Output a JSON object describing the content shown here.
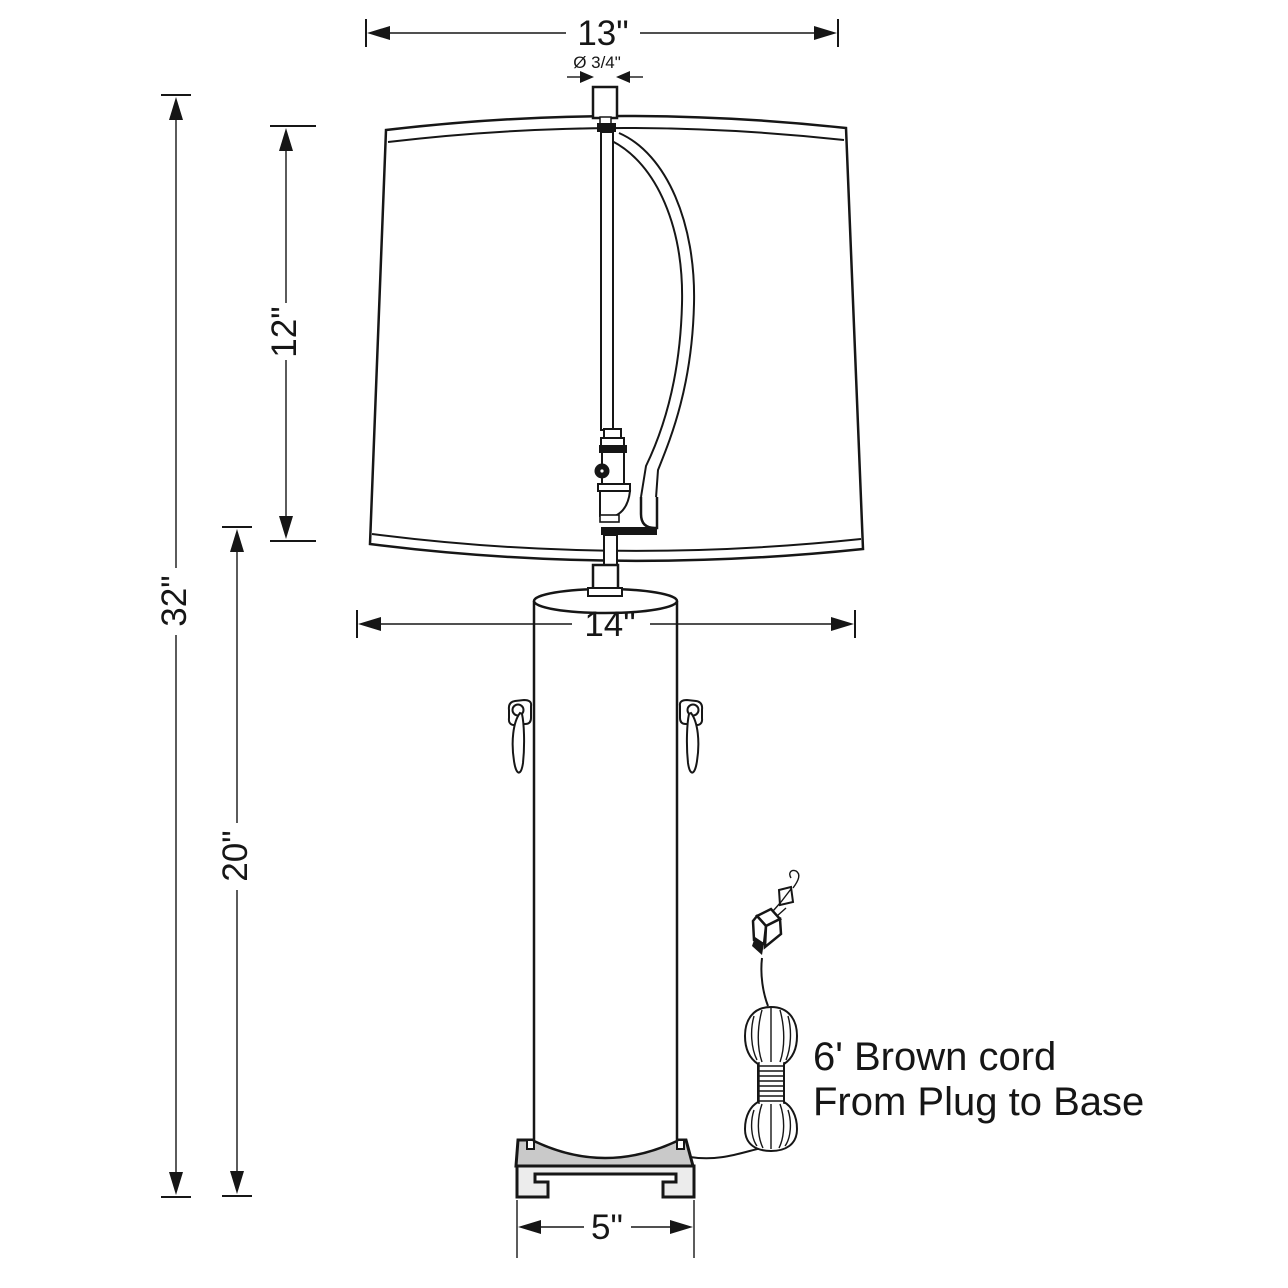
{
  "drawing": {
    "title": "table-lamp-dimension-diagram",
    "dimensions": {
      "shade_top_width": "13\"",
      "finial_diameter": "Ø 3/4\"",
      "shade_height": "12\"",
      "total_height": "32\"",
      "body_top_width": "14\"",
      "body_height": "20\"",
      "base_width": "5\""
    },
    "note": {
      "line1": "6' Brown cord",
      "line2": "From Plug to Base"
    },
    "colors": {
      "line": "#161616",
      "base_slab_fill": "#c9c9c9",
      "base_foot_fill": "#ececec",
      "background": "#ffffff"
    }
  }
}
